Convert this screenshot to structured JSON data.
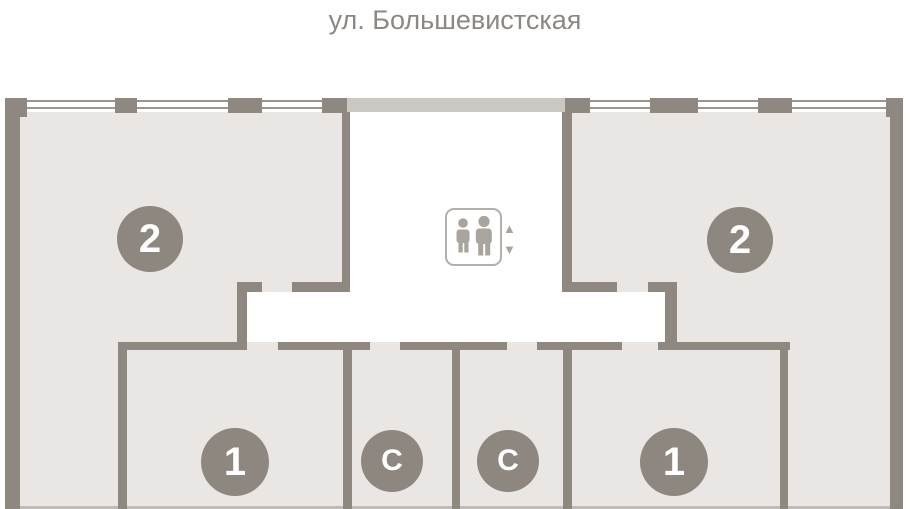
{
  "title": "ул. Большевистская",
  "floorplan": {
    "rooms": [
      {
        "id": "apt-2-left",
        "label": "2"
      },
      {
        "id": "apt-2-right",
        "label": "2"
      },
      {
        "id": "apt-1-left",
        "label": "1"
      },
      {
        "id": "studio-left",
        "label": "С"
      },
      {
        "id": "studio-right",
        "label": "С"
      },
      {
        "id": "apt-1-right",
        "label": "1"
      }
    ],
    "elevator": {
      "icon": "elevator-people-icon",
      "arrow_up": "▲",
      "arrow_down": "▼"
    }
  },
  "colors": {
    "wall": "#8e8880",
    "room_fill": "#e9e6e3",
    "top_band": "#cbc7c2",
    "circle": "#8d8780",
    "window_line": "#9a958e",
    "title_text": "#8c8780",
    "elevator_gray": "#a9a49e"
  }
}
